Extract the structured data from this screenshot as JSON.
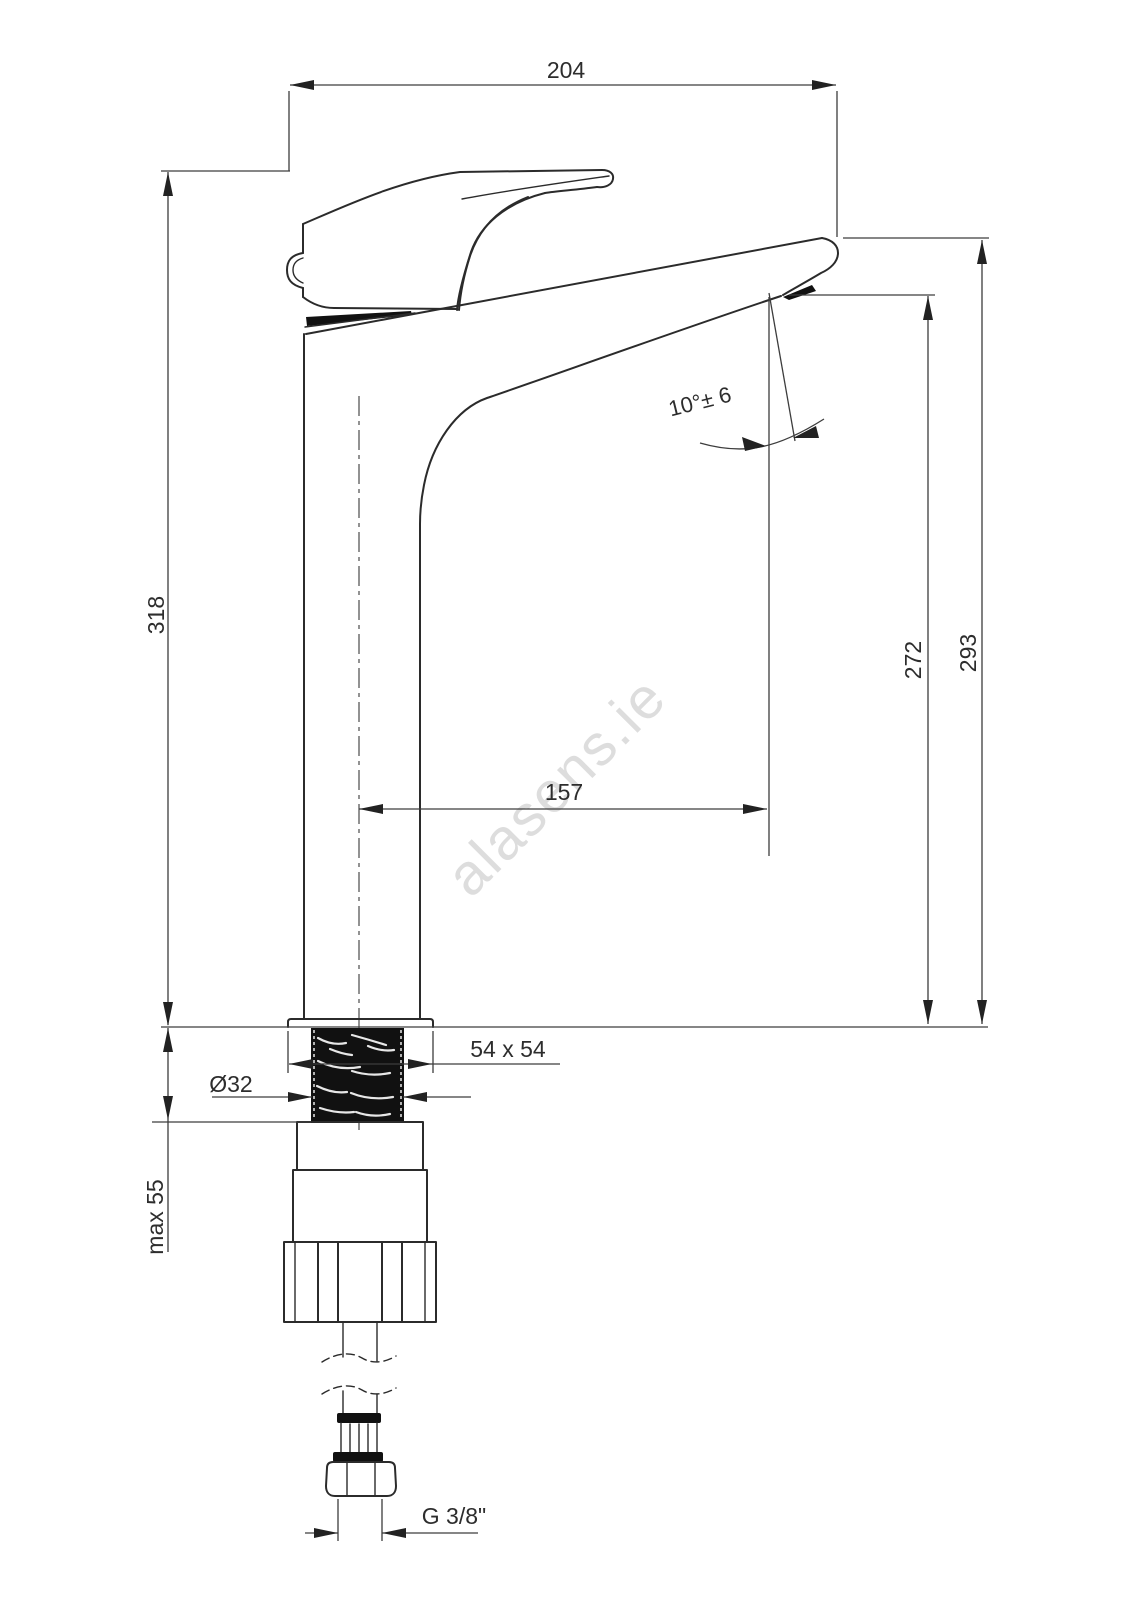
{
  "drawing": {
    "watermark": "alasens.ie",
    "dimensions": {
      "overall_reach": "204",
      "overall_height": "318",
      "outlet_height": "272",
      "spout_top_height": "293",
      "outlet_projection": "157",
      "spout_angle": "10°± 6",
      "base_plate": "54 x 54",
      "shank_diameter": "Ø32",
      "max_mount_thickness": "max 55",
      "hose_connection": "G 3/8\""
    }
  }
}
